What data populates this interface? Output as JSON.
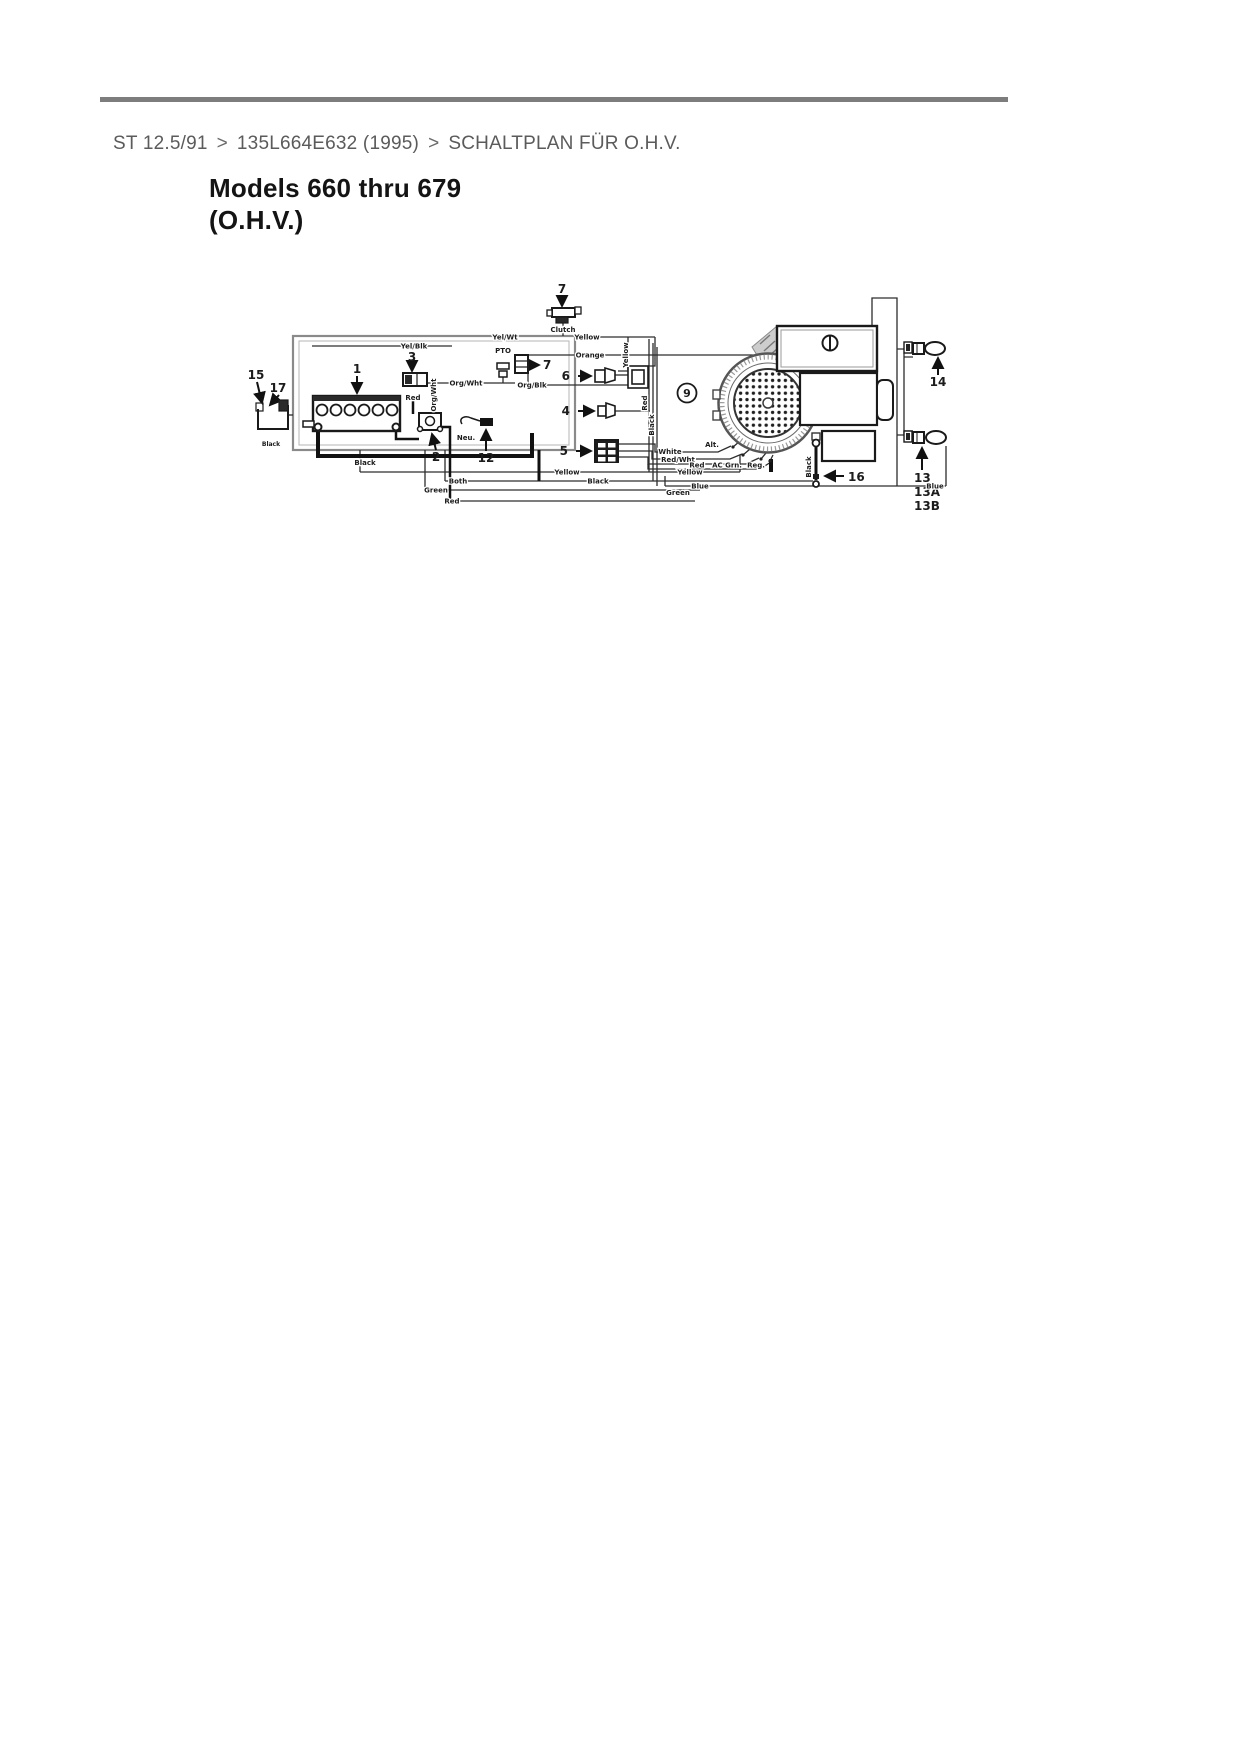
{
  "page": {
    "breadcrumb": {
      "items": [
        "ST 12.5/91",
        "135L664E632 (1995)",
        "SCHALTPLAN FÜR O.H.V."
      ],
      "separator": ">"
    }
  },
  "diagram": {
    "title_line1": "Models 660 thru 679",
    "title_line2": "(O.H.V.)",
    "callouts": {
      "c1": "1",
      "c2": "2",
      "c3": "3",
      "c4": "4",
      "c5": "5",
      "c6": "6",
      "c7": "7",
      "c9": "9",
      "c12": "12",
      "c13": "13",
      "c13a": "13A",
      "c13b": "13B",
      "c14": "14",
      "c15": "15",
      "c16": "16",
      "c17": "17"
    },
    "labels": {
      "yel_wt": "Yel/Wt",
      "yellow": "Yellow",
      "yel_blk": "Yel/Blk",
      "orange": "Orange",
      "pto": "PTO",
      "clutch": "Clutch",
      "org_wht": "Org/Wht",
      "org_blk": "Org/Blk",
      "red": "Red",
      "neu": "Neu.",
      "white": "White",
      "red_wht": "Red/Wht",
      "ac_grn": "AC Grn.",
      "alt": "Alt.",
      "reg": "Reg.",
      "black": "Black",
      "blue": "Blue",
      "both": "Both",
      "green": "Green"
    }
  }
}
